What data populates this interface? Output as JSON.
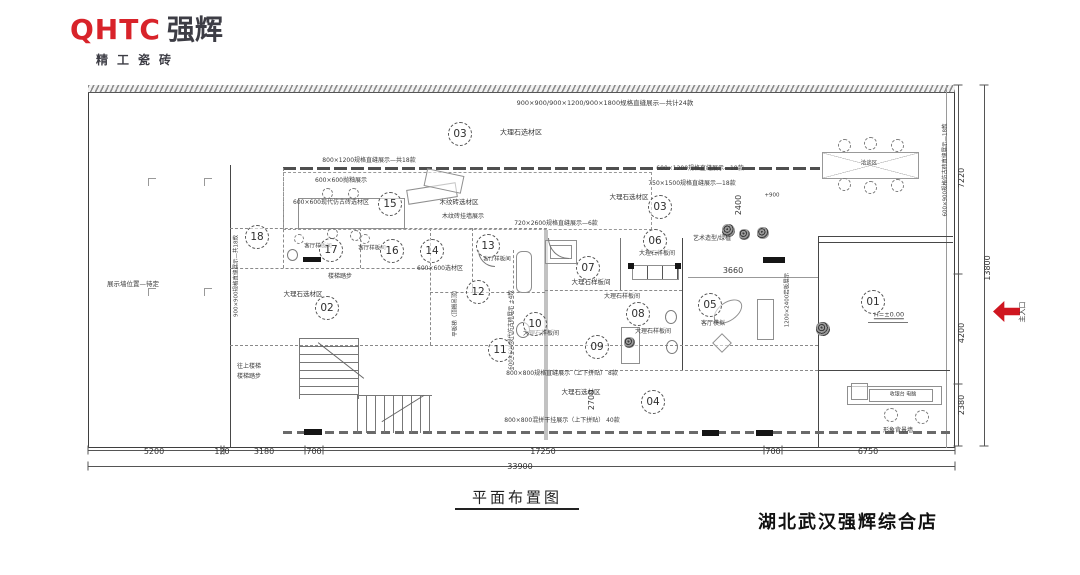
{
  "logo": {
    "mark": "QHTC",
    "brand": "强辉",
    "tagline": "精工瓷砖"
  },
  "footer": {
    "drawing_title": "平面布置图",
    "store_name": "湖北武汉强辉综合店"
  },
  "colors": {
    "logo_red": "#d8232a",
    "logo_dark": "#3d3d45",
    "entrance_red": "#cf1620",
    "line": "#474747"
  },
  "entrance": {
    "label": "主入口"
  },
  "plan": {
    "zones": [
      {
        "n": "01",
        "x": 873,
        "y": 302
      },
      {
        "n": "02",
        "x": 327,
        "y": 308
      },
      {
        "n": "03",
        "x": 460,
        "y": 134
      },
      {
        "n": "03",
        "x": 660,
        "y": 207
      },
      {
        "n": "04",
        "x": 653,
        "y": 402
      },
      {
        "n": "05",
        "x": 710,
        "y": 305
      },
      {
        "n": "06",
        "x": 655,
        "y": 241
      },
      {
        "n": "07",
        "x": 588,
        "y": 268
      },
      {
        "n": "08",
        "x": 638,
        "y": 314
      },
      {
        "n": "09",
        "x": 597,
        "y": 347
      },
      {
        "n": "10",
        "x": 535,
        "y": 324
      },
      {
        "n": "11",
        "x": 500,
        "y": 350
      },
      {
        "n": "12",
        "x": 478,
        "y": 292
      },
      {
        "n": "13",
        "x": 488,
        "y": 246
      },
      {
        "n": "14",
        "x": 432,
        "y": 251
      },
      {
        "n": "15",
        "x": 390,
        "y": 204
      },
      {
        "n": "16",
        "x": 392,
        "y": 251
      },
      {
        "n": "17",
        "x": 331,
        "y": 250
      },
      {
        "n": "18",
        "x": 257,
        "y": 237
      }
    ],
    "labels": [
      {
        "t": "900×900/900×1200/900×1800规格直缝展示—共计24款",
        "x": 605,
        "y": 103,
        "s": 6.5
      },
      {
        "t": "大理石选材区",
        "x": 521,
        "y": 133,
        "s": 7
      },
      {
        "t": "800×1200规格直缝展示—共18款",
        "x": 369,
        "y": 161,
        "s": 6
      },
      {
        "t": "600×600抛釉展示",
        "x": 341,
        "y": 181,
        "s": 6
      },
      {
        "t": "600×600现代仿古砖选材区",
        "x": 331,
        "y": 203,
        "s": 6
      },
      {
        "t": "木纹砖选材区",
        "x": 459,
        "y": 202,
        "s": 6.5
      },
      {
        "t": "木纹砖挂墙展示",
        "x": 463,
        "y": 217,
        "s": 6
      },
      {
        "t": "600×1200规格直缝展示—18款",
        "x": 700,
        "y": 169,
        "s": 6
      },
      {
        "t": "750×1500规格直缝展示—18款",
        "x": 692,
        "y": 184,
        "s": 6
      },
      {
        "t": "大理石选材区",
        "x": 629,
        "y": 197,
        "s": 6.5
      },
      {
        "t": "+900",
        "x": 772,
        "y": 196,
        "s": 5.5
      },
      {
        "t": "720×2600规格直缝展示—6款",
        "x": 556,
        "y": 224,
        "s": 6
      },
      {
        "t": "客厅样板间",
        "x": 318,
        "y": 247,
        "s": 5.5
      },
      {
        "t": "客厅样板间",
        "x": 372,
        "y": 249,
        "s": 5.5
      },
      {
        "t": "客厅样板间",
        "x": 497,
        "y": 260,
        "s": 5.5
      },
      {
        "t": "楼梯踏步",
        "x": 340,
        "y": 277,
        "s": 6
      },
      {
        "t": "大理石选材区",
        "x": 303,
        "y": 294,
        "s": 6.5
      },
      {
        "t": "600×600选材区",
        "x": 440,
        "y": 269,
        "s": 6
      },
      {
        "t": "大理石样板间",
        "x": 657,
        "y": 254,
        "s": 6
      },
      {
        "t": "大理石样板间",
        "x": 591,
        "y": 282,
        "s": 6.5
      },
      {
        "t": "大理石样板间",
        "x": 622,
        "y": 297,
        "s": 6
      },
      {
        "t": "大理石样板间",
        "x": 541,
        "y": 334,
        "s": 6
      },
      {
        "t": "大理石样板间",
        "x": 653,
        "y": 332,
        "s": 6
      },
      {
        "t": "艺术造型/绿植",
        "x": 712,
        "y": 239,
        "s": 6
      },
      {
        "t": "3660",
        "x": 733,
        "y": 271,
        "s": 8
      },
      {
        "t": "客厅模拟",
        "x": 713,
        "y": 324,
        "s": 6
      },
      {
        "t": "H=±0.00",
        "x": 889,
        "y": 315,
        "s": 6.5,
        "u": 1
      },
      {
        "t": "展示墙位置—待定",
        "x": 133,
        "y": 284,
        "s": 6.5
      },
      {
        "t": "往上楼梯",
        "x": 249,
        "y": 367,
        "s": 6
      },
      {
        "t": "楼梯踏步",
        "x": 249,
        "y": 377,
        "s": 6
      },
      {
        "t": "800×800规格直缝展示（上下拼贴） 8款",
        "x": 562,
        "y": 374,
        "s": 6
      },
      {
        "t": "大理石选材区",
        "x": 581,
        "y": 392,
        "s": 6.5
      },
      {
        "t": "800×800混拼干挂展示（上下拼贴） 40款",
        "x": 562,
        "y": 421,
        "s": 6
      },
      {
        "t": "洽谈区",
        "x": 869,
        "y": 164,
        "s": 5.5
      },
      {
        "t": "收银台 电脑",
        "x": 903,
        "y": 395,
        "s": 5
      },
      {
        "t": "形象背景墙",
        "x": 898,
        "y": 431,
        "s": 6
      },
      {
        "t": "900×900规格直缝展示—共18款",
        "x": 237,
        "y": 276,
        "s": 5.5,
        "r": -90
      },
      {
        "t": "600×900规格仿古砖直缝展示—18款",
        "x": 946,
        "y": 170,
        "s": 5.5,
        "r": -90
      },
      {
        "t": "2400",
        "x": 739,
        "y": 205,
        "s": 8,
        "r": -90
      },
      {
        "t": "2700",
        "x": 592,
        "y": 400,
        "s": 8,
        "r": -90
      },
      {
        "t": "平板梯（顶棚吊顶）",
        "x": 456,
        "y": 312,
        "s": 5.5,
        "r": -90
      },
      {
        "t": "600×600现代仿古砖展示 ±4款",
        "x": 512,
        "y": 330,
        "s": 5.5,
        "r": -90
      },
      {
        "t": "1200×2400岩板展示",
        "x": 788,
        "y": 300,
        "s": 5.5,
        "r": -90
      }
    ],
    "dims": [
      {
        "t": "5200",
        "x": 154,
        "y": 452
      },
      {
        "t": "120",
        "x": 222,
        "y": 452
      },
      {
        "t": "3180",
        "x": 264,
        "y": 452
      },
      {
        "t": "700",
        "x": 314,
        "y": 452
      },
      {
        "t": "17250",
        "x": 543,
        "y": 452
      },
      {
        "t": "700",
        "x": 773,
        "y": 452
      },
      {
        "t": "6750",
        "x": 868,
        "y": 452
      },
      {
        "t": "33900",
        "x": 520,
        "y": 467
      },
      {
        "t": "7220",
        "x": 962,
        "y": 178,
        "r": -90
      },
      {
        "t": "4200",
        "x": 962,
        "y": 333,
        "r": -90
      },
      {
        "t": "2380",
        "x": 962,
        "y": 405,
        "r": -90
      },
      {
        "t": "13800",
        "x": 988,
        "y": 268,
        "r": -90
      }
    ]
  }
}
